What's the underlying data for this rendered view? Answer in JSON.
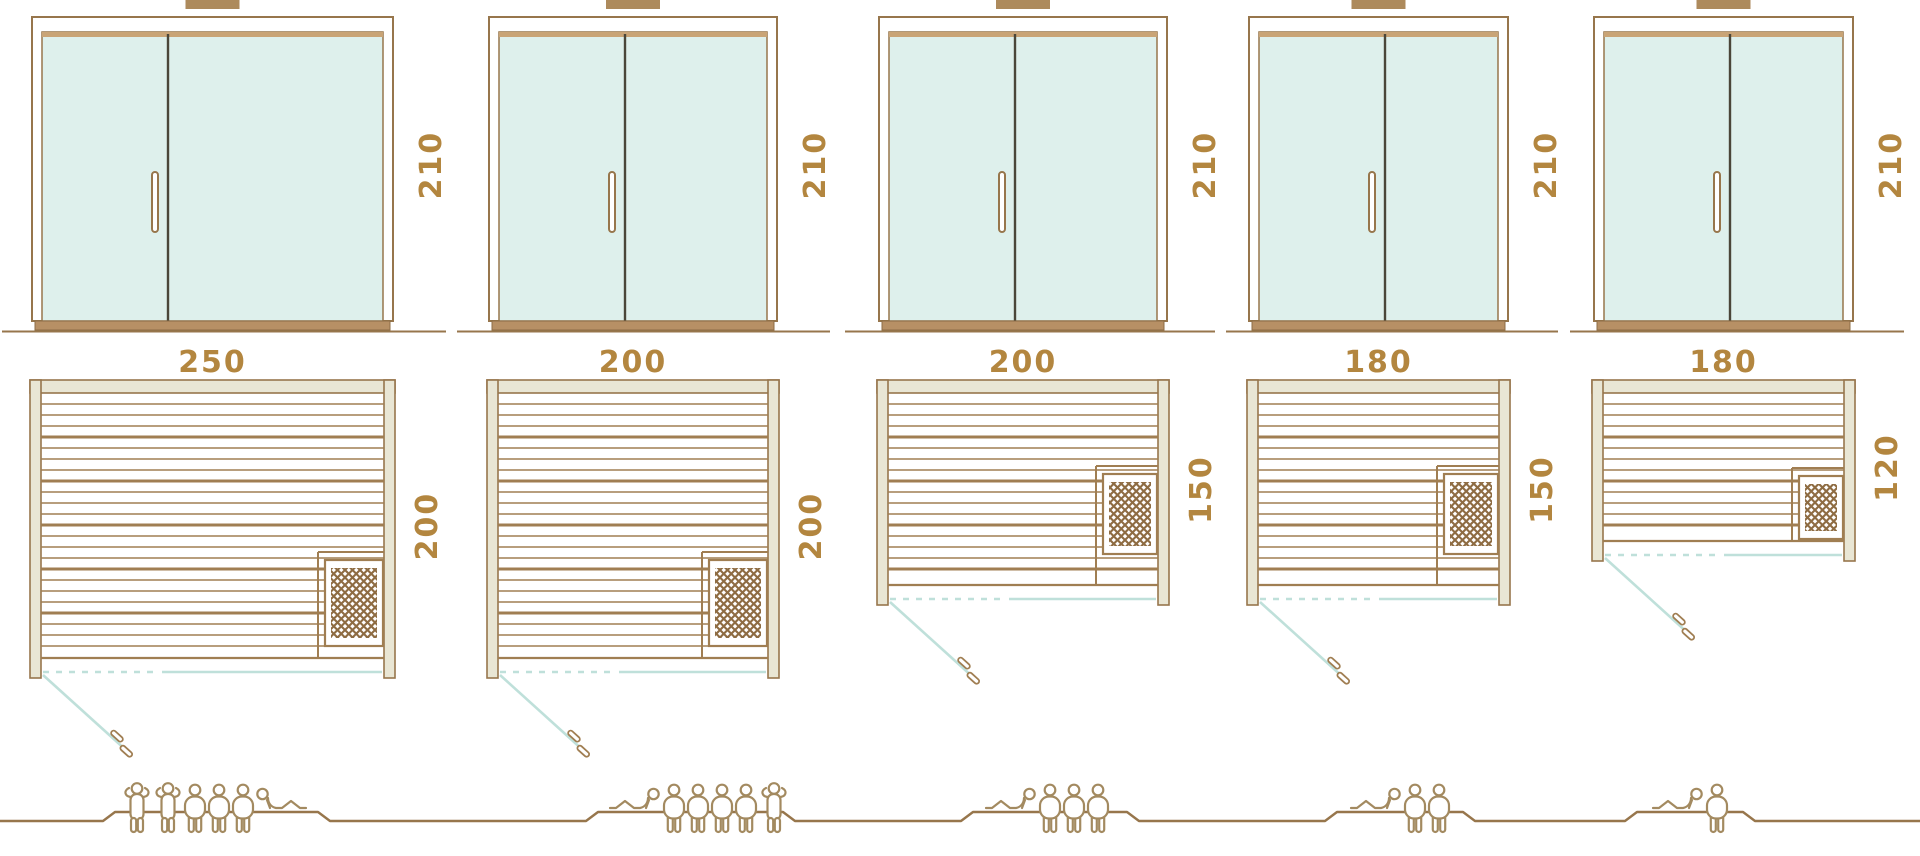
{
  "diagram": {
    "kind": "sauna-size-comparison",
    "views": [
      "door-front-elevation",
      "floor-plan",
      "capacity-figures"
    ]
  },
  "colors": {
    "outline_brown": "#97764c",
    "plank_brown": "#a07e52",
    "beige_wall": "#e9e6d4",
    "glass_teal": "#def0ec",
    "tan_top_bar": "#c9a476",
    "tan_sill": "#b79065",
    "door_seam_dark": "#4a4639",
    "dimension_text": "#b3863f",
    "door_line_teal": "#bfe0da",
    "people_brown": "#a38a60",
    "heater_hatch_brown": "#8e6c42",
    "vent_tab_brown": "#ad8a5c",
    "background": "#ffffff"
  },
  "saunas": [
    {
      "name": "sauna-250x200",
      "door": {
        "height_label": "210"
      },
      "plan": {
        "width_label": "250",
        "depth_label": "200"
      },
      "capacity": {
        "persons": 6,
        "figures": [
          "standing",
          "standing",
          "sitting",
          "sitting",
          "sitting",
          "lying-right"
        ]
      }
    },
    {
      "name": "sauna-200x200",
      "door": {
        "height_label": "210"
      },
      "plan": {
        "width_label": "200",
        "depth_label": "200"
      },
      "capacity": {
        "persons": 6,
        "figures": [
          "lying-left",
          "sitting",
          "sitting",
          "sitting",
          "sitting",
          "standing"
        ]
      }
    },
    {
      "name": "sauna-200x150",
      "door": {
        "height_label": "210"
      },
      "plan": {
        "width_label": "200",
        "depth_label": "150"
      },
      "capacity": {
        "persons": 4,
        "figures": [
          "lying-left",
          "sitting",
          "sitting",
          "sitting"
        ]
      }
    },
    {
      "name": "sauna-180x150",
      "door": {
        "height_label": "210"
      },
      "plan": {
        "width_label": "180",
        "depth_label": "150"
      },
      "capacity": {
        "persons": 3,
        "figures": [
          "lying-left",
          "sitting",
          "sitting"
        ]
      }
    },
    {
      "name": "sauna-180x120",
      "door": {
        "height_label": "210"
      },
      "plan": {
        "width_label": "180",
        "depth_label": "120"
      },
      "capacity": {
        "persons": 2,
        "figures": [
          "lying-left",
          "sitting"
        ]
      }
    }
  ]
}
